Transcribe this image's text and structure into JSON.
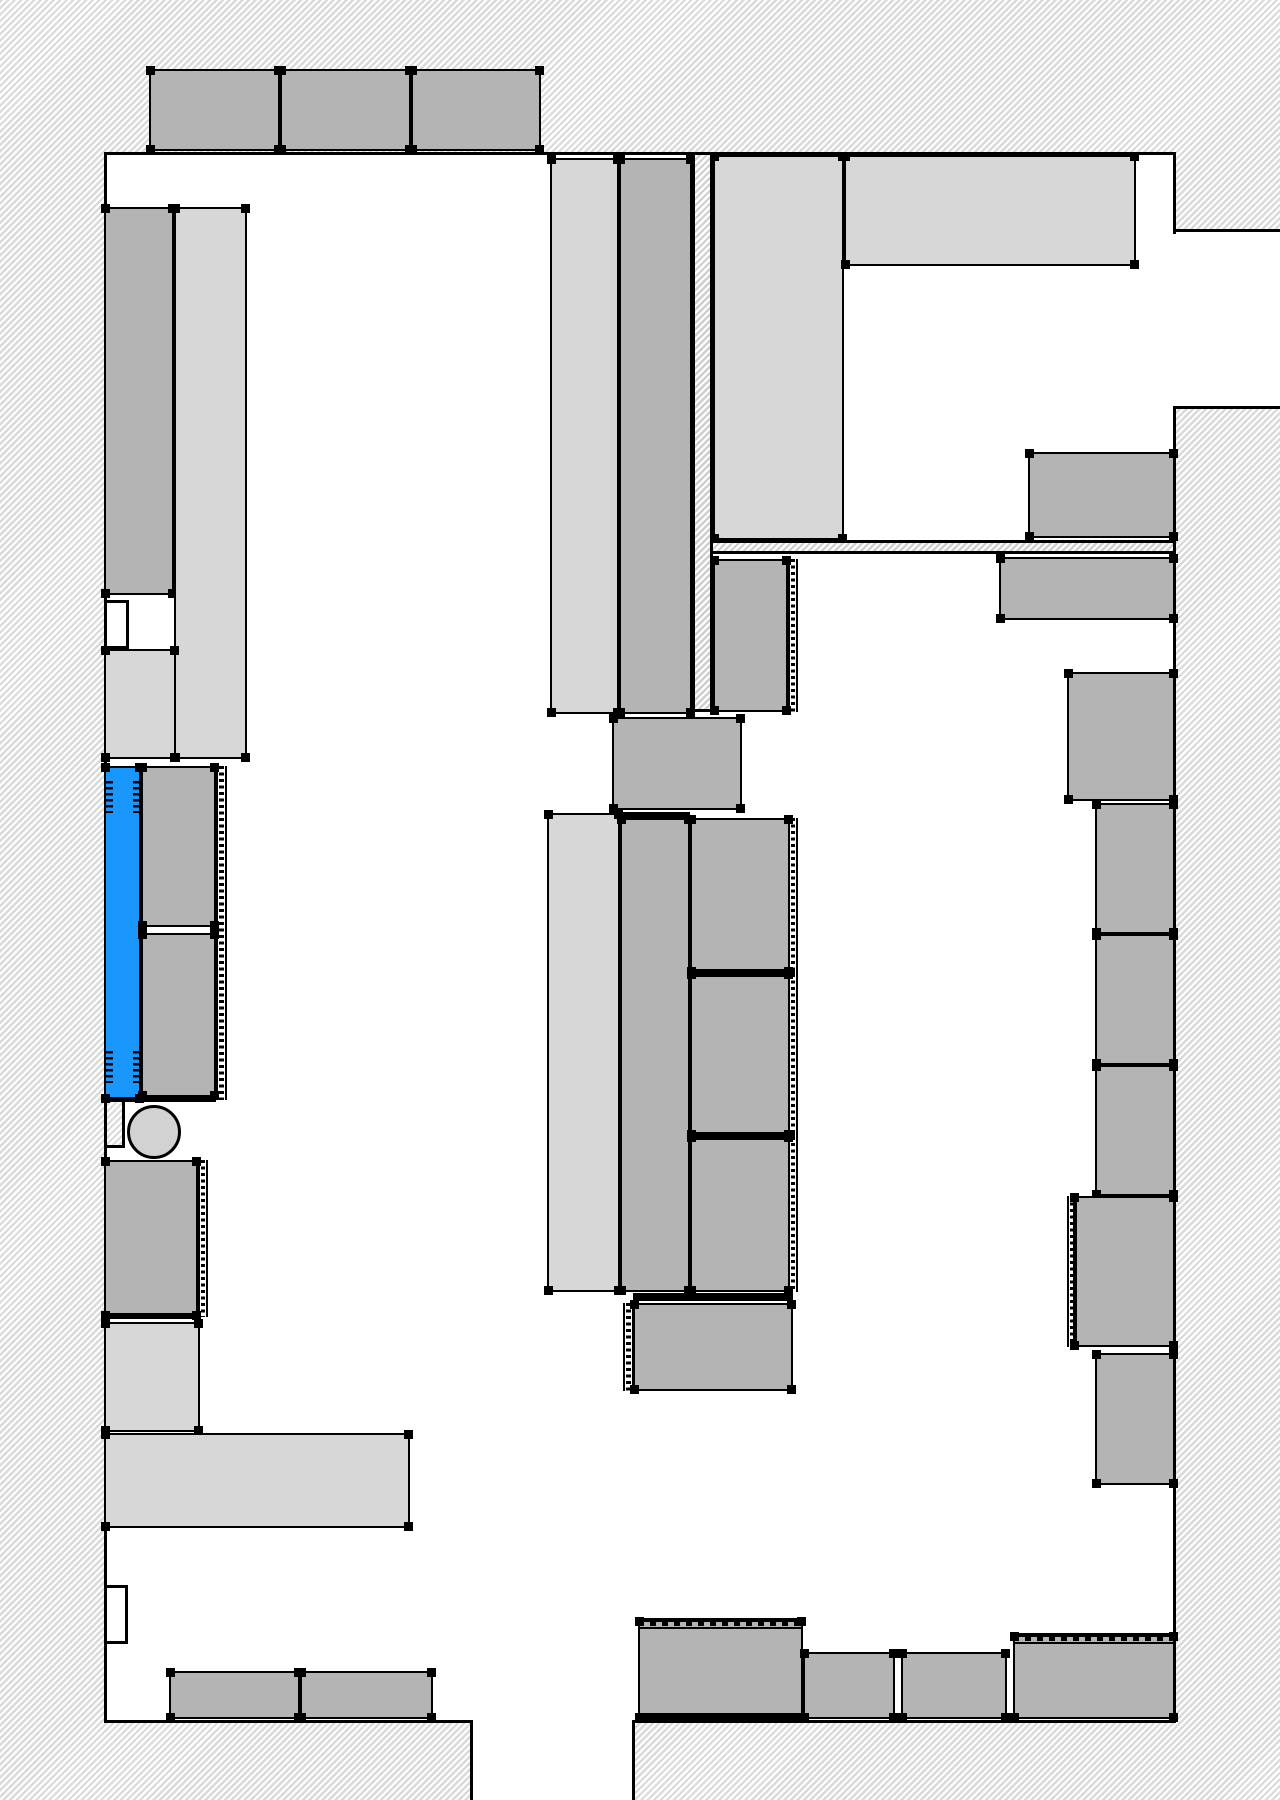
{
  "canvas": {
    "width": 1280,
    "height": 1800
  },
  "colors": {
    "fixture_dark": "#b4b4b4",
    "fixture_light": "#d7d7d7",
    "selected_blue": "#1a97fc",
    "wall_line": "#000000",
    "hatch_stripe": "#dadada",
    "floor": "#ffffff"
  },
  "rooms": [
    {
      "name": "main-floor-area",
      "x": 104,
      "y": 152,
      "w": 1071,
      "h": 1568
    },
    {
      "name": "right-corridor-opening",
      "x": 1175,
      "y": 231,
      "w": 105,
      "h": 176
    },
    {
      "name": "bottom-exit-opening",
      "x": 473,
      "y": 1720,
      "w": 159,
      "h": 80
    }
  ],
  "interior_walls": [
    {
      "name": "interior-wall-horizontal",
      "x": 711,
      "y": 540,
      "w": 464,
      "h": 14,
      "edges": "tb"
    },
    {
      "name": "interior-wall-vertical",
      "x": 692,
      "y": 152,
      "w": 21,
      "h": 560,
      "edges": "lrb"
    }
  ],
  "wall_lines": [
    {
      "name": "top-wall",
      "x": 104,
      "y": 152,
      "w": 1072,
      "h": 3
    },
    {
      "name": "left-wall",
      "x": 104,
      "y": 152,
      "w": 3,
      "h": 1571
    },
    {
      "name": "right-wall-upper",
      "x": 1173,
      "y": 152,
      "w": 3,
      "h": 82
    },
    {
      "name": "corridor-top-wall",
      "x": 1173,
      "y": 229,
      "w": 107,
      "h": 3
    },
    {
      "name": "corridor-bottom-wall",
      "x": 1173,
      "y": 406,
      "w": 107,
      "h": 3
    },
    {
      "name": "right-wall-lower",
      "x": 1173,
      "y": 406,
      "w": 3,
      "h": 1317
    },
    {
      "name": "bottom-wall-left",
      "x": 104,
      "y": 1720,
      "w": 369,
      "h": 3
    },
    {
      "name": "bottom-wall-right",
      "x": 632,
      "y": 1720,
      "w": 543,
      "h": 3
    },
    {
      "name": "exit-jamb-left",
      "x": 470,
      "y": 1720,
      "w": 3,
      "h": 80
    },
    {
      "name": "exit-jamb-right",
      "x": 632,
      "y": 1720,
      "w": 3,
      "h": 80
    }
  ],
  "notches": [
    {
      "name": "door-recess-upper",
      "x": 104,
      "y": 600,
      "w": 25,
      "h": 49,
      "kind": "white"
    },
    {
      "name": "door-recess-lower",
      "x": 104,
      "y": 1585,
      "w": 24,
      "h": 59,
      "kind": "white"
    },
    {
      "name": "wall-pillar-bump",
      "x": 104,
      "y": 1100,
      "w": 21,
      "h": 48,
      "kind": "hatch"
    }
  ],
  "fixtures": [
    {
      "name": "top-shelf-1",
      "x": 149,
      "y": 69,
      "w": 131,
      "h": 82,
      "fill": "dark"
    },
    {
      "name": "top-shelf-2",
      "x": 280,
      "y": 69,
      "w": 131,
      "h": 82,
      "fill": "dark"
    },
    {
      "name": "top-shelf-3",
      "x": 411,
      "y": 69,
      "w": 130,
      "h": 82,
      "fill": "dark"
    },
    {
      "name": "left-tall-shelf-dark",
      "x": 104,
      "y": 207,
      "w": 70,
      "h": 388,
      "fill": "dark"
    },
    {
      "name": "left-tall-shelf-light",
      "x": 174,
      "y": 207,
      "w": 73,
      "h": 552,
      "fill": "light"
    },
    {
      "name": "left-shelf-light-extension",
      "x": 104,
      "y": 649,
      "w": 72,
      "h": 110,
      "fill": "light"
    },
    {
      "name": "selected-fixture-blue",
      "x": 104,
      "y": 766,
      "w": 37,
      "h": 334,
      "fill": "blue"
    },
    {
      "name": "left-mid-shelf-1",
      "x": 141,
      "y": 766,
      "w": 75,
      "h": 161,
      "fill": "dark"
    },
    {
      "name": "left-mid-shelf-2",
      "x": 141,
      "y": 933,
      "w": 75,
      "h": 164,
      "fill": "dark"
    },
    {
      "name": "left-lower-shelf-dark",
      "x": 104,
      "y": 1160,
      "w": 94,
      "h": 157,
      "fill": "dark"
    },
    {
      "name": "left-lower-shelf-light",
      "x": 104,
      "y": 1322,
      "w": 96,
      "h": 110,
      "fill": "light"
    },
    {
      "name": "left-counter-bar",
      "x": 104,
      "y": 1433,
      "w": 306,
      "h": 95,
      "fill": "light"
    },
    {
      "name": "bottom-left-shelf-1",
      "x": 169,
      "y": 1671,
      "w": 131,
      "h": 48,
      "fill": "dark"
    },
    {
      "name": "bottom-left-shelf-2",
      "x": 300,
      "y": 1671,
      "w": 133,
      "h": 48,
      "fill": "dark"
    },
    {
      "name": "center-aisle-light-upper",
      "x": 550,
      "y": 158,
      "w": 69,
      "h": 556,
      "fill": "light"
    },
    {
      "name": "center-aisle-dark-upper",
      "x": 619,
      "y": 158,
      "w": 73,
      "h": 556,
      "fill": "dark"
    },
    {
      "name": "upper-room-light-strip",
      "x": 713,
      "y": 155,
      "w": 131,
      "h": 385,
      "fill": "light"
    },
    {
      "name": "upper-room-light-block",
      "x": 844,
      "y": 155,
      "w": 292,
      "h": 111,
      "fill": "light"
    },
    {
      "name": "below-wall-small-shelf",
      "x": 713,
      "y": 559,
      "w": 75,
      "h": 153,
      "fill": "dark"
    },
    {
      "name": "wall-mounted-shelf",
      "x": 999,
      "y": 557,
      "w": 176,
      "h": 63,
      "fill": "dark"
    },
    {
      "name": "center-island-box",
      "x": 612,
      "y": 717,
      "w": 130,
      "h": 93,
      "fill": "dark"
    },
    {
      "name": "center-aisle-light-lower",
      "x": 547,
      "y": 813,
      "w": 73,
      "h": 479,
      "fill": "light"
    },
    {
      "name": "center-aisle-dark-lower",
      "x": 620,
      "y": 818,
      "w": 70,
      "h": 474,
      "fill": "dark"
    },
    {
      "name": "center-column-shelf-1",
      "x": 690,
      "y": 818,
      "w": 100,
      "h": 155,
      "fill": "dark"
    },
    {
      "name": "center-column-shelf-2",
      "x": 690,
      "y": 973,
      "w": 100,
      "h": 163,
      "fill": "dark"
    },
    {
      "name": "center-column-shelf-3",
      "x": 690,
      "y": 1136,
      "w": 100,
      "h": 156,
      "fill": "dark"
    },
    {
      "name": "center-end-cap-shelf",
      "x": 633,
      "y": 1303,
      "w": 160,
      "h": 88,
      "fill": "dark"
    },
    {
      "name": "right-upper-shelf",
      "x": 1028,
      "y": 452,
      "w": 147,
      "h": 86,
      "fill": "dark"
    },
    {
      "name": "right-column-shelf-1",
      "x": 1067,
      "y": 672,
      "w": 108,
      "h": 129,
      "fill": "dark"
    },
    {
      "name": "right-column-shelf-2",
      "x": 1095,
      "y": 803,
      "w": 80,
      "h": 131,
      "fill": "dark"
    },
    {
      "name": "right-column-shelf-3",
      "x": 1095,
      "y": 934,
      "w": 80,
      "h": 131,
      "fill": "dark"
    },
    {
      "name": "right-column-shelf-4",
      "x": 1095,
      "y": 1065,
      "w": 80,
      "h": 131,
      "fill": "dark"
    },
    {
      "name": "right-column-shelf-5",
      "x": 1073,
      "y": 1196,
      "w": 102,
      "h": 151,
      "fill": "dark"
    },
    {
      "name": "right-column-shelf-6",
      "x": 1095,
      "y": 1353,
      "w": 80,
      "h": 132,
      "fill": "dark"
    },
    {
      "name": "bottom-shelf-a",
      "x": 638,
      "y": 1620,
      "w": 165,
      "h": 99,
      "fill": "dark"
    },
    {
      "name": "bottom-shelf-b",
      "x": 803,
      "y": 1652,
      "w": 92,
      "h": 67,
      "fill": "dark"
    },
    {
      "name": "bottom-shelf-c",
      "x": 901,
      "y": 1652,
      "w": 106,
      "h": 67,
      "fill": "dark"
    },
    {
      "name": "bottom-shelf-d",
      "x": 1013,
      "y": 1635,
      "w": 162,
      "h": 84,
      "fill": "dark"
    }
  ],
  "circle": {
    "name": "round-table",
    "cx": 154,
    "cy": 1132,
    "r": 27
  },
  "tick_strips": [
    {
      "name": "shelf-edge-ticks-left-mid",
      "x": 216,
      "y": 766,
      "w": 11,
      "h": 334,
      "dir": "v"
    },
    {
      "name": "shelf-edge-ticks-left-lower",
      "x": 198,
      "y": 1160,
      "w": 10,
      "h": 157,
      "dir": "v"
    },
    {
      "name": "shelf-edge-ticks-below-wall",
      "x": 788,
      "y": 559,
      "w": 10,
      "h": 153,
      "dir": "v"
    },
    {
      "name": "shelf-edge-ticks-center-column",
      "x": 788,
      "y": 818,
      "w": 10,
      "h": 474,
      "dir": "v"
    },
    {
      "name": "shelf-edge-ticks-end-cap",
      "x": 623,
      "y": 1303,
      "w": 11,
      "h": 88,
      "dir": "v"
    },
    {
      "name": "shelf-edge-ticks-right-column",
      "x": 1067,
      "y": 1196,
      "w": 10,
      "h": 151,
      "dir": "v"
    },
    {
      "name": "shelf-edge-ticks-bottom-a",
      "x": 638,
      "y": 1618,
      "w": 165,
      "h": 11,
      "dir": "h"
    },
    {
      "name": "shelf-edge-ticks-bottom-d",
      "x": 1013,
      "y": 1633,
      "w": 162,
      "h": 11,
      "dir": "h"
    }
  ],
  "combs": [
    {
      "name": "selection-comb-top-left",
      "x": 106,
      "y": 781,
      "w": 7,
      "h": 32
    },
    {
      "name": "selection-comb-top-right",
      "x": 133,
      "y": 781,
      "w": 7,
      "h": 32
    },
    {
      "name": "selection-comb-bottom-left",
      "x": 106,
      "y": 1051,
      "w": 7,
      "h": 32
    },
    {
      "name": "selection-comb-bottom-right",
      "x": 133,
      "y": 1051,
      "w": 7,
      "h": 32
    }
  ],
  "heavy_bars": [
    {
      "name": "thick-edge-left-lower",
      "x": 104,
      "y": 1313,
      "w": 94,
      "h": 6
    },
    {
      "name": "thick-edge-left-mid-bottom",
      "x": 104,
      "y": 1097,
      "w": 112,
      "h": 5
    },
    {
      "name": "thick-edge-aisle-lower-top",
      "x": 620,
      "y": 812,
      "w": 70,
      "h": 7
    },
    {
      "name": "thick-divider-column-1",
      "x": 690,
      "y": 969,
      "w": 105,
      "h": 8
    },
    {
      "name": "thick-divider-column-2",
      "x": 690,
      "y": 1132,
      "w": 105,
      "h": 8
    },
    {
      "name": "thick-divider-end-cap",
      "x": 633,
      "y": 1293,
      "w": 160,
      "h": 8
    },
    {
      "name": "thick-edge-bottom-a",
      "x": 638,
      "y": 1713,
      "w": 165,
      "h": 7
    }
  ]
}
